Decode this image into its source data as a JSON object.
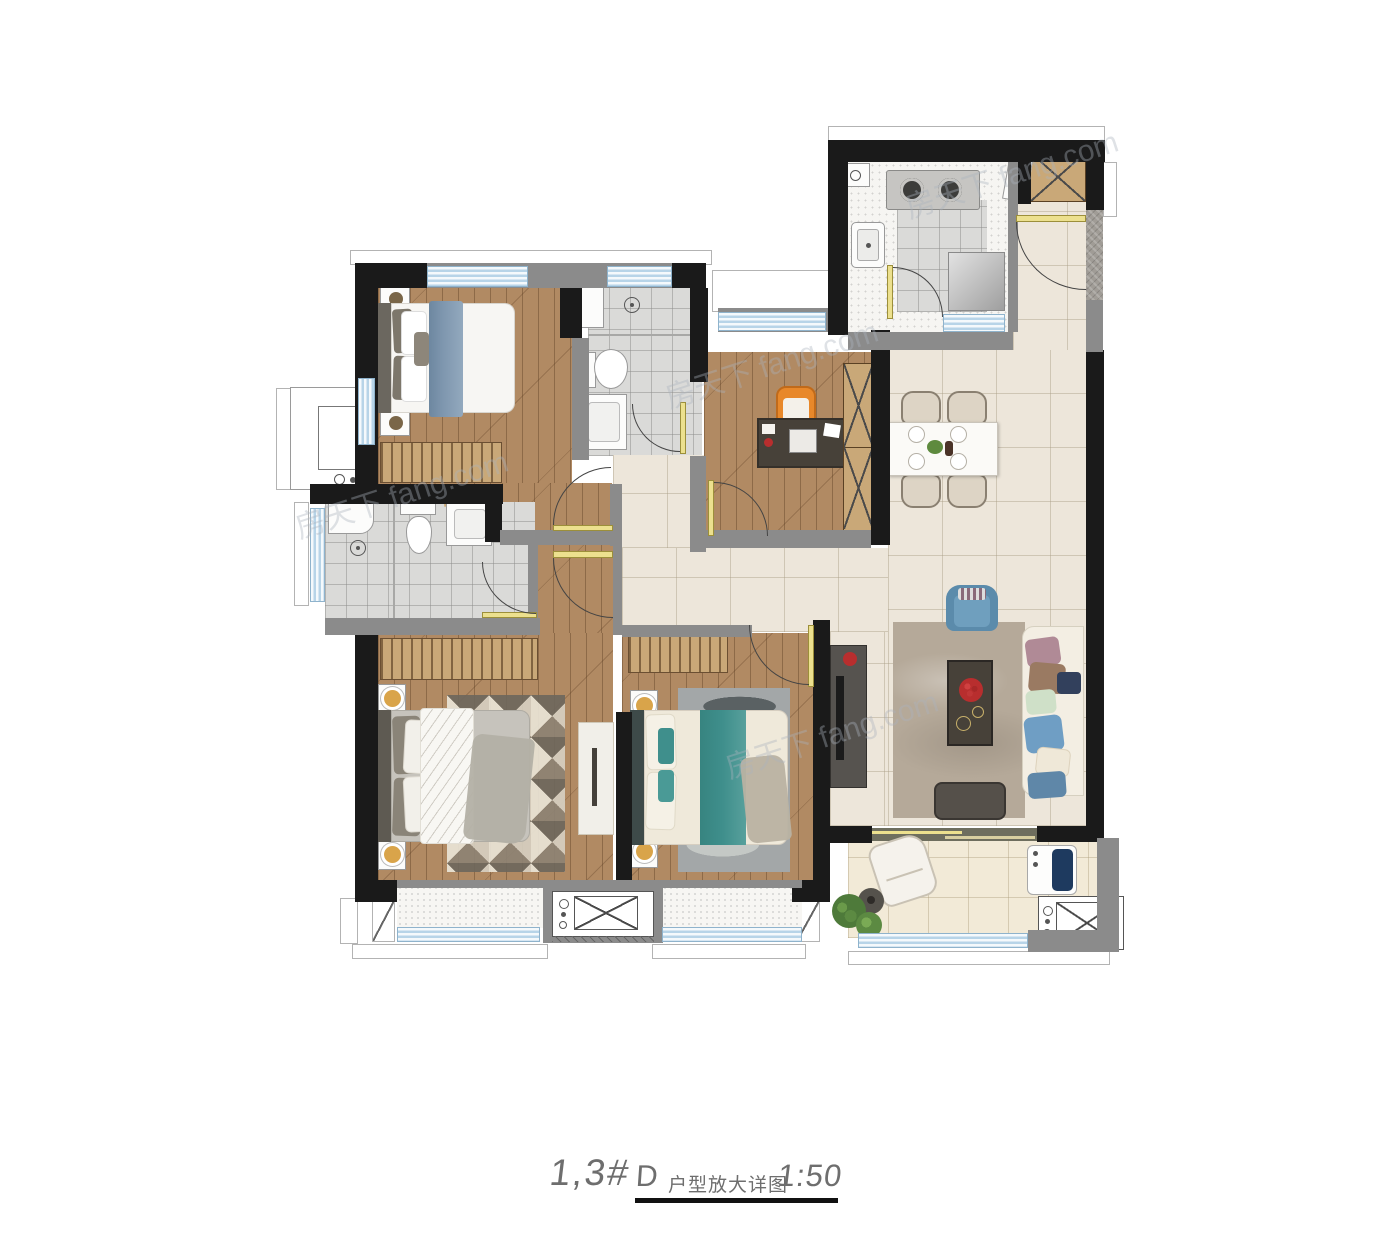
{
  "title": {
    "building": "1,3#",
    "drawing_code": "D",
    "drawing_name": "户型放大详图",
    "scale": "1:50"
  },
  "watermark": {
    "text": "房天下 fang.com"
  },
  "palette": {
    "wall_black": "#1a1a1a",
    "wall_gray": "#8b8b8b",
    "stone_gray": "#a09c96",
    "window_blue": "#b7d4e8",
    "door_yellow": "#ece08e",
    "wood_floor": "#b18a63",
    "wood_furniture": "#c9a878",
    "tile_cream": "#ede6da",
    "bath_tile": "#dadad8",
    "balcony_tile": "#f2ead7",
    "bed_blue": "#7e96ae",
    "teal": "#3f8f8c",
    "orange_chair": "#e8882a",
    "sofa_cream": "#f3eee3",
    "rug_living": "#b5a999",
    "rug_gray": "#a3a7a8",
    "red_accent": "#b82e2e",
    "navy_drum": "#1e3a5f",
    "armchair_blue": "#6f9fbe",
    "dark_table": "#474139",
    "tv_dark": "#56534f",
    "marble_white": "#f1efe9"
  }
}
